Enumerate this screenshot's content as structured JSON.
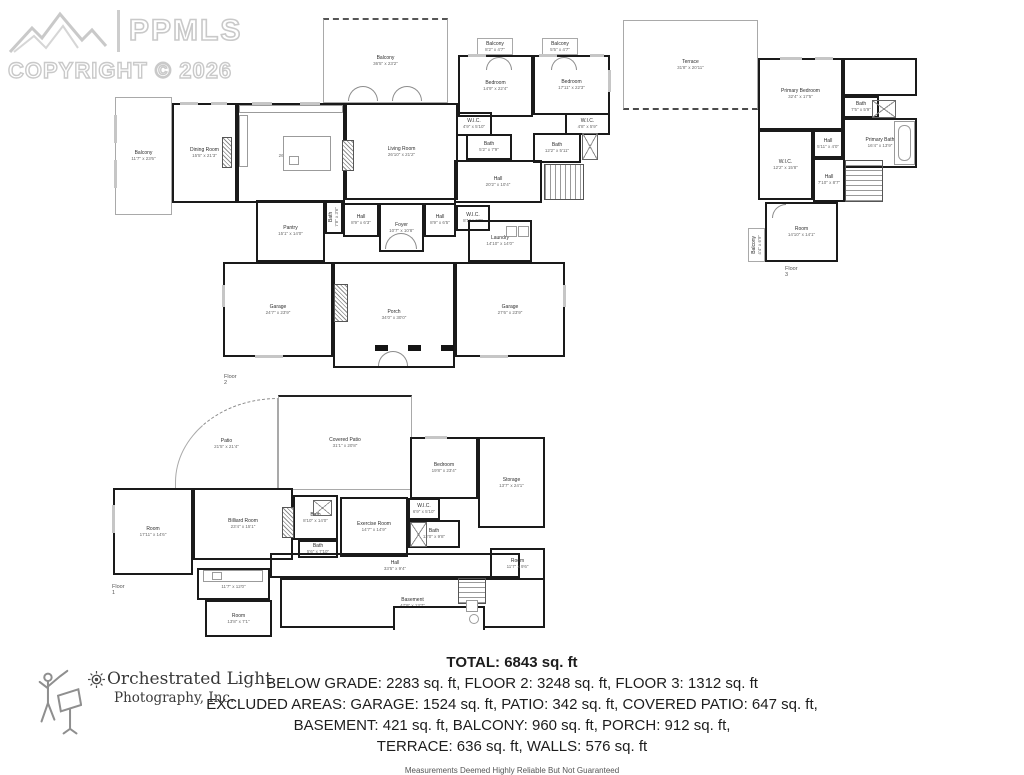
{
  "watermark": {
    "brand": "PPMLS",
    "copyright": "COPYRIGHT © 2026"
  },
  "floors": {
    "floor2": {
      "label": "Floor 2",
      "rooms": [
        {
          "name": "Balcony",
          "dims": "11'7\" x 23'6\""
        },
        {
          "name": "Balcony",
          "dims": "36'5\" x 23'2\""
        },
        {
          "name": "Balcony",
          "dims": "8'2\" x 4'7\""
        },
        {
          "name": "Balcony",
          "dims": "5'5\" x 4'7\""
        },
        {
          "name": "Dining Room",
          "dims": "15'5\" x 21'3\""
        },
        {
          "name": "Kitchen",
          "dims": "26'7\" x 21'3\""
        },
        {
          "name": "Living Room",
          "dims": "26'10\" x 21'2\""
        },
        {
          "name": "Bedroom",
          "dims": "14'9\" x 22'4\""
        },
        {
          "name": "Bedroom",
          "dims": "17'11\" x 22'3\""
        },
        {
          "name": "W.I.C.",
          "dims": "4'9\" x 5'10\""
        },
        {
          "name": "Bath",
          "dims": "5'2\" x 7'9\""
        },
        {
          "name": "W.I.C.",
          "dims": "4'8\" x 5'9\""
        },
        {
          "name": "Bath",
          "dims": "12'2\" x 5'11\""
        },
        {
          "name": "Hall",
          "dims": "20'2\" x 10'4\""
        },
        {
          "name": "Pantry",
          "dims": "15'1\" x 14'0\""
        },
        {
          "name": "Bath",
          "dims": "7'8\" x 3'6\""
        },
        {
          "name": "Hall",
          "dims": "8'9\" x 6'3\""
        },
        {
          "name": "Foyer",
          "dims": "10'7\" x 10'8\""
        },
        {
          "name": "Hall",
          "dims": "8'9\" x 6'5\""
        },
        {
          "name": "W.I.C.",
          "dims": "8'1\" x 6'9\""
        },
        {
          "name": "Laundry",
          "dims": "14'10\" x 14'0\""
        },
        {
          "name": "Garage",
          "dims": "24'7\" x 23'9\""
        },
        {
          "name": "Porch",
          "dims": "34'0\" x 30'0\""
        },
        {
          "name": "Garage",
          "dims": "27'6\" x 23'9\""
        }
      ]
    },
    "floor3": {
      "label": "Floor 3",
      "rooms": [
        {
          "name": "Terrace",
          "dims": "31'8\" x 20'11\""
        },
        {
          "name": "Primary Bedroom",
          "dims": "32'4\" x 17'5\""
        },
        {
          "name": "Bath",
          "dims": "7'5\" x 5'9\""
        },
        {
          "name": "Primary Bath",
          "dims": "16'4\" x 13'9\""
        },
        {
          "name": "W.I.C.",
          "dims": "12'2\" x 15'8\""
        },
        {
          "name": "Hall",
          "dims": "5'11\" x 4'0\""
        },
        {
          "name": "Hall",
          "dims": "7'10\" x 8'7\""
        },
        {
          "name": "Room",
          "dims": "14'10\" x 14'1\""
        },
        {
          "name": "Balcony",
          "dims": "4'4\" x 6'9\""
        }
      ]
    },
    "floor1": {
      "label": "Floor 1",
      "rooms": [
        {
          "name": "Patio",
          "dims": "21'5\" x 21'4\""
        },
        {
          "name": "Covered Patio",
          "dims": "31'1\" x 20'8\""
        },
        {
          "name": "Room",
          "dims": "17'11\" x 14'6\""
        },
        {
          "name": "Billiard Room",
          "dims": "23'4\" x 15'1\""
        },
        {
          "name": "Bedroom",
          "dims": "19'8\" x 23'4\""
        },
        {
          "name": "Storage",
          "dims": "13'7\" x 24'1\""
        },
        {
          "name": "Exercise Room",
          "dims": "14'7\" x 14'9\""
        },
        {
          "name": "W.I.C.",
          "dims": "6'9\" x 5'10\""
        },
        {
          "name": "Bath",
          "dims": "12'0\" x 9'8\""
        },
        {
          "name": "Bath",
          "dims": "8'10\" x 14'0\""
        },
        {
          "name": "Bath",
          "dims": "5'6\" x 7'10\""
        },
        {
          "name": "Hall",
          "dims": "33'5\" x 9'4\""
        },
        {
          "name": "Wet Bar",
          "dims": "11'7\" x 12'0\""
        },
        {
          "name": "Room",
          "dims": "13'8\" x 7'1\""
        },
        {
          "name": "Basement",
          "dims": "47'9\" x 13'7\""
        },
        {
          "name": "Room",
          "dims": "11'7\" x 9'6\""
        }
      ]
    }
  },
  "summary": {
    "total": "TOTAL: 6843 sq. ft",
    "line2": "BELOW GRADE: 2283 sq. ft, FLOOR 2: 3248 sq. ft, FLOOR 3: 1312 sq. ft",
    "line3": "EXCLUDED AREAS: GARAGE: 1524 sq. ft, PATIO: 342 sq. ft, COVERED PATIO: 647 sq. ft,",
    "line4": "BASEMENT: 421 sq. ft, BALCONY: 960 sq. ft, PORCH: 912 sq. ft,",
    "line5": "TERRACE: 636 sq. ft, WALLS: 576 sq. ft",
    "disclaimer": "Measurements Deemed Highly Reliable But Not Guaranteed"
  },
  "credit": {
    "name": "Orchestrated Light",
    "subtitle": "Photography, Inc."
  }
}
